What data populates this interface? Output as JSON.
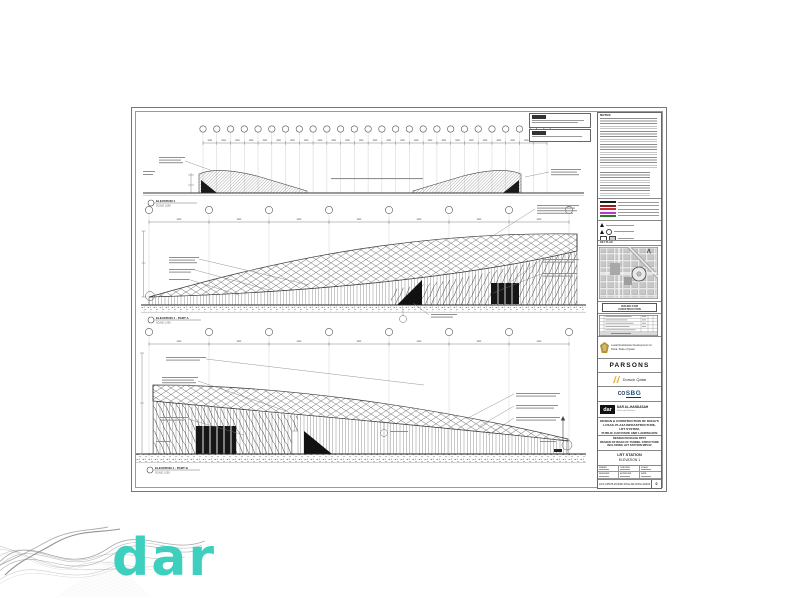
{
  "watermark": {
    "logo_text": "dar"
  },
  "sheet": {
    "elevations": [
      {
        "label": "ELEVATION 1",
        "scale": "SCALE 1:500"
      },
      {
        "label": "ELEVATION 1 - PART A",
        "scale": "SCALE 1:200"
      },
      {
        "label": "ELEVATION 1 - PART B",
        "scale": "SCALE 1:200"
      }
    ],
    "title_block": {
      "notes_title": "NOTES:",
      "key_plan_title": "KEY PLAN",
      "stamp": {
        "line1": "ISSUED FOR",
        "line2": "CONSTRUCTION"
      },
      "client": {
        "line1": "Lusail Real Estate Development Co.",
        "line2": "Doha, State of Qatar"
      },
      "logos": {
        "parsons": "PARSONS",
        "dorsch": "Dorsch Qatar",
        "sbg_prefix": "CO",
        "sbg": "SBG",
        "dar_mark": "dar",
        "dar_name": "DAR AL-HANDASAH",
        "dar_sub": "Shair and Partners"
      },
      "project_desc": {
        "line1": "DESIGN & CONSTRUCTION OF DOHA'S",
        "line2": "LUSAIL PLAZA INFRASTRUCTURE, LRT SYSTEM,",
        "line3": "PUBLIC CAR PARK AND LANDSCAPE"
      },
      "package_desc": {
        "line1": "DESIGN PACKAGE DP37",
        "line2": "DESIGN OF ROAD 2C TUNNEL STRUCTURE",
        "line3": "INCLUDING LRT STATION MPL02"
      },
      "drawing_title": {
        "line1": "LRT STATION",
        "line2": "ELEVATION 1"
      },
      "fields": {
        "drawn": "DRAWN",
        "designed": "DESIGNED",
        "checked": "CHECKED",
        "approved": "APPROVED",
        "scale": "SCALE",
        "date": "DATE"
      },
      "status": "ISSUED FOR CONSTRUCTION",
      "drawing_number": "LUS-CP078-DCD00-DOH-AR-DWG-00402",
      "revision": "0"
    }
  },
  "colors": {
    "dar_teal": "#3ecfbf",
    "legend_black": "#1a1a1a",
    "legend_dark_red": "#8b2020",
    "legend_red": "#c03030",
    "legend_magenta": "#c433c4",
    "legend_green": "#2a7a2a",
    "dorsch_yellow": "#e8a821",
    "sbg_blue": "#1a5276",
    "lusail_gold": "#b5932f"
  }
}
